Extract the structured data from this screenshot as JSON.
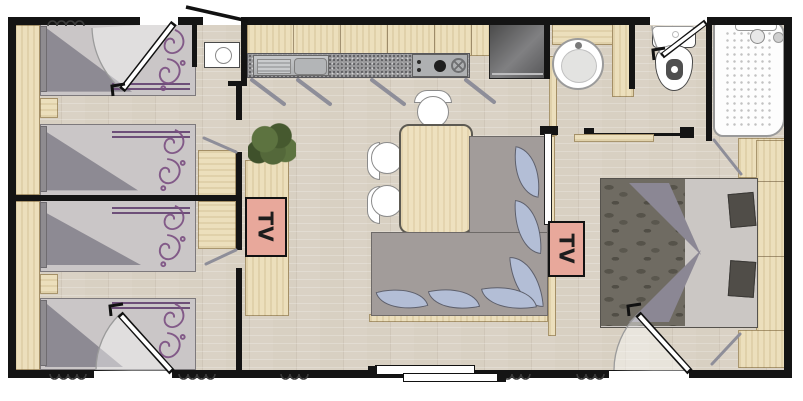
{
  "floor_plan": {
    "tv_labels": [
      "TV",
      "TV"
    ],
    "colors": {
      "wall": "#141414",
      "floor_wood": "#d8d0c2",
      "furniture_wood": "#ecdfbc",
      "tv_accent": "#e8a89b",
      "sofa_gray": "#a29c9a",
      "cushion_blue": "#b3bed6",
      "bedding_purple": "#6d4f79",
      "counter_granite": "#99999b"
    }
  }
}
